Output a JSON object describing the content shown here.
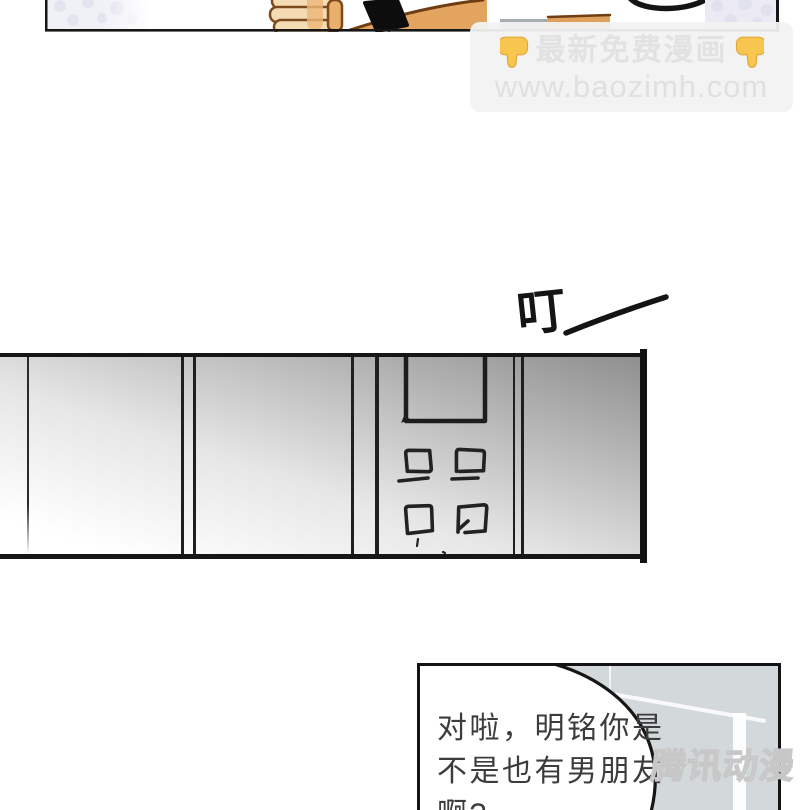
{
  "site_watermark": {
    "line1": "最新免费漫画",
    "line2": "www.baozimh.com",
    "pointer_icon": "down-pointing-hand",
    "pointer_color": "#f7c64e",
    "box_color": "#f2f2f3",
    "text_color": "#e2e2e2"
  },
  "sfx": {
    "character": "叮",
    "dash": "—",
    "color": "#141414"
  },
  "speech_bubble": {
    "lines": [
      "对啦，明铭你是",
      "不是也有男朋友",
      "啊?"
    ],
    "text_color": "#3c3c3c"
  },
  "logo_watermark": {
    "text": "腾讯动漫"
  },
  "panels": {
    "middle_panel_kind": "gradient wall with door window and hand-drawn buttons",
    "bottom_panel_bg": "#d3d8da",
    "border_color": "#141414"
  }
}
